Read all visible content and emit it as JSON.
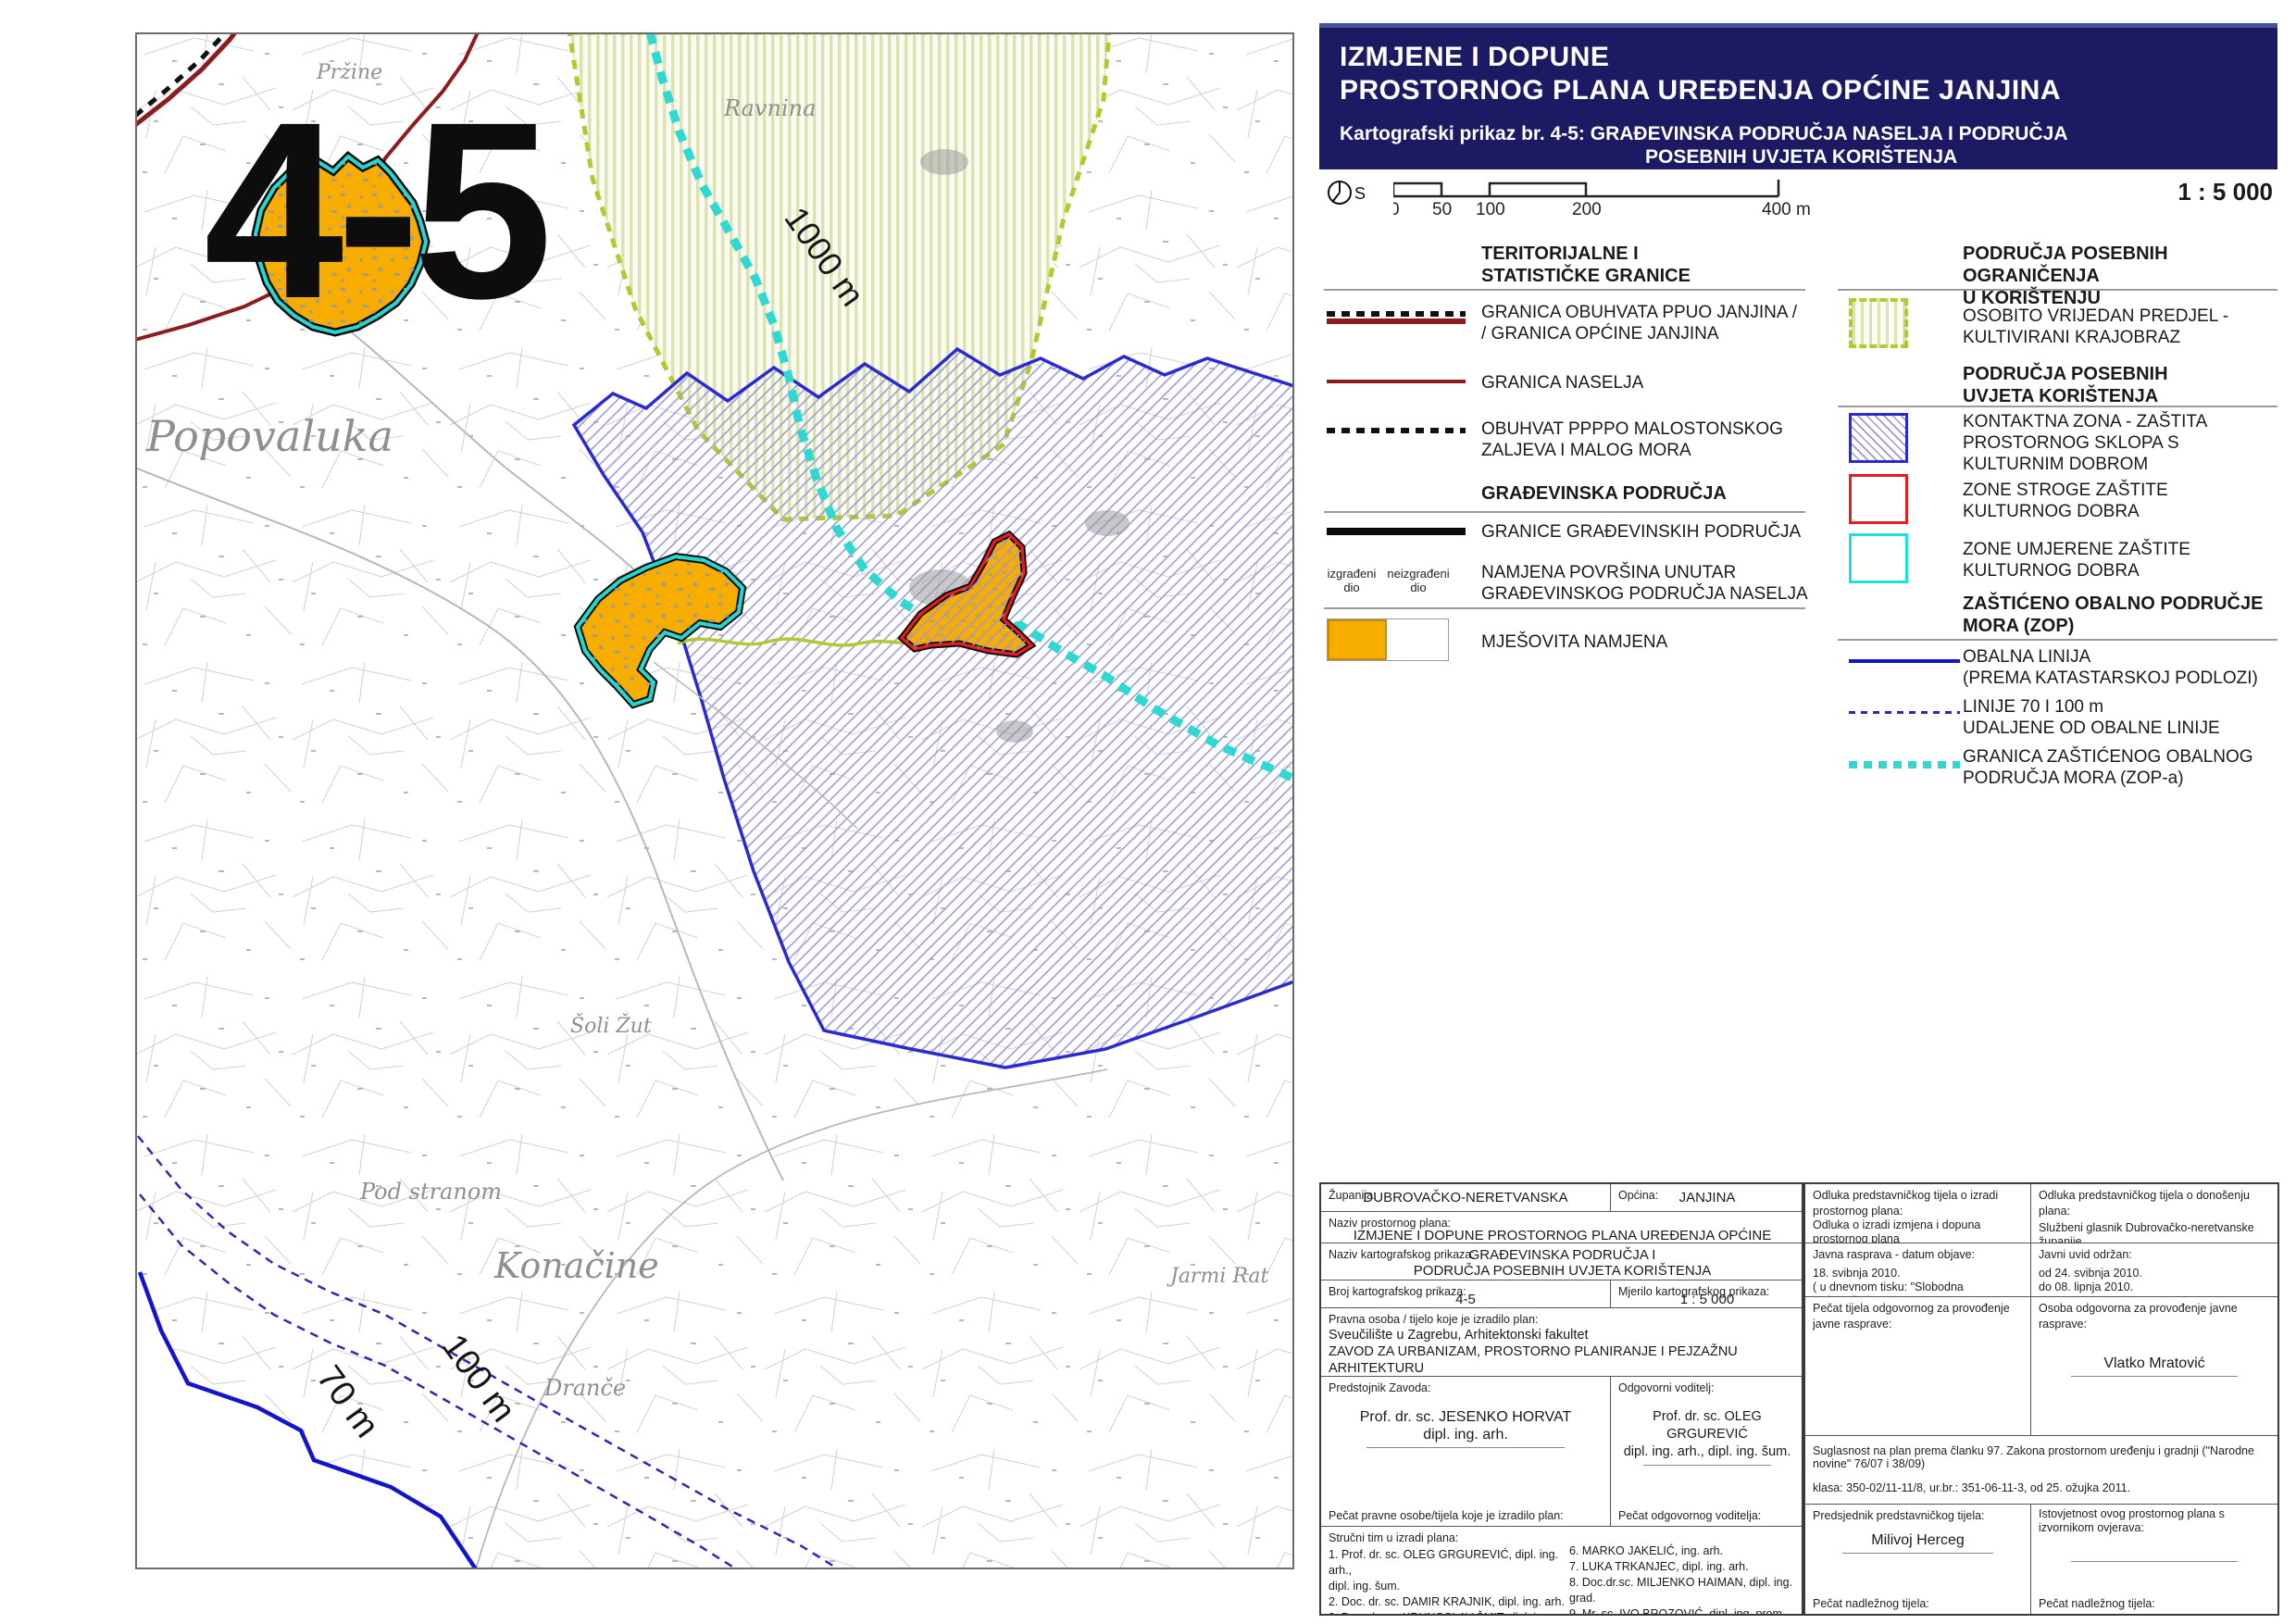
{
  "colors": {
    "title_navy": "#1b1a63",
    "mixed_use_orange": "#f7ac00",
    "settlement_border_black": "#0c0c0c",
    "settlement_inner_cyan": "#28d6d0",
    "granica_naselja_maroon": "#8e1b1e",
    "zop_cyan": "#2fd9d2",
    "coast_navy": "#1414cc",
    "kontaktna_blue": "#2a2ad0",
    "stroge_red": "#e31e1e",
    "umjerene_cyan": "#22dede",
    "krajobraz_olive": "#b5c832"
  },
  "title_block": {
    "line1": "IZMJENE I DOPUNE",
    "line2": "PROSTORNOG PLANA UREĐENJA OPĆINE JANJINA",
    "sub1": "Kartografski prikaz br. 4-5: GRAĐEVINSKA PODRUČJA NASELJA I PODRUČJA",
    "sub2": "POSEBNIH UVJETA KORIŠTENJA"
  },
  "scale_bar": {
    "north_label": "S",
    "ticks": [
      "0",
      "50",
      "100",
      "200",
      "400 m"
    ],
    "ratio": "1 : 5 000"
  },
  "legend": {
    "left": {
      "header1": "TERITORIJALNE I\nSTATISTIČKE GRANICE",
      "item1": "GRANICA OBUHVATA PPUO JANJINA /\n/ GRANICA OPĆINE JANJINA",
      "item2": "GRANICA NASELJA",
      "item3": "OBUHVAT PPPPO MALOSTONSKOG\nZALJEVA  I MALOG MORA",
      "header2": "GRAĐEVINSKA PODRUČJA",
      "item4": "GRANICE GRAĐEVINSKIH PODRUČJA",
      "built_label": "izgrađeni\ndio",
      "unbuilt_label": "neizgrađeni\ndio",
      "item5_header": "NAMJENA POVRŠINA UNUTAR\nGRAĐEVINSKOG PODRUČJA NASELJA",
      "item5": "MJEŠOVITA NAMJENA"
    },
    "right": {
      "header1": "PODRUČJA POSEBNIH OGRANIČENJA\nU KORIŠTENJU",
      "item1": "OSOBITO VRIJEDAN PREDJEL -\nKULTIVIRANI KRAJOBRAZ",
      "header2": "PODRUČJA POSEBNIH\nUVJETA KORIŠTENJA",
      "item2": "KONTAKTNA ZONA - ZAŠTITA\nPROSTORNOG SKLOPA S\nKULTURNIM DOBROM",
      "item3": "ZONE STROGE ZAŠTITE\nKULTURNOG DOBRA",
      "item4": "ZONE UMJERENE ZAŠTITE\nKULTURNOG DOBRA",
      "header3": "ZAŠTIĆENO OBALNO PODRUČJE\nMORA (ZOP)",
      "item5": "OBALNA LINIJA\n(PREMA KATASTARSKOJ PODLOZI)",
      "item6": "LINIJE 70 I 100 m\nUDALJENE OD OBALNE LINIJE",
      "item7": "GRANICA ZAŠTIĆENOG OBALNOG\nPODRUČJA MORA (ZOP-a)"
    }
  },
  "map": {
    "sheet_number": "4-5",
    "labels": [
      {
        "text": "Pržine"
      },
      {
        "text": "Ravnina"
      },
      {
        "text": "Popovaluka"
      },
      {
        "text": "Šoli Žut"
      },
      {
        "text": "Pod stranom"
      },
      {
        "text": "Konačine"
      },
      {
        "text": "Dranče"
      },
      {
        "text": "Jarmi Rat"
      },
      {
        "text": "1000 m"
      },
      {
        "text": "100 m"
      },
      {
        "text": "70 m"
      }
    ]
  },
  "table": {
    "zupanija_label": "Županija:",
    "zupanija_value": "DUBROVAČKO-NERETVANSKA",
    "opcina_label": "Općina:",
    "opcina_value": "JANJINA",
    "naziv_plana_label": "Naziv prostornog plana:",
    "naziv_plana_value": "IZMJENE I DOPUNE PROSTORNOG PLANA UREĐENJA OPĆINE JANJINA",
    "naziv_prikaza_label": "Naziv kartografskog prikaza:",
    "naziv_prikaza_value": "GRAĐEVINSKA PODRUČJA I\nPODRUČJA POSEBNIH UVJETA KORIŠTENJA",
    "broj_label": "Broj kartografskog prikaza:",
    "broj_value": "4-5",
    "mjerilo_label": "Mjerilo kartografskog prikaza:",
    "mjerilo_value": "1 : 5 000",
    "pravna_label": "Pravna osoba / tijelo koje je izradilo plan:",
    "pravna_value": "Sveučilište u Zagrebu, Arhitektonski fakultet\nZAVOD ZA URBANIZAM, PROSTORNO PLANIRANJE I PEJZAŽNU ARHITEKTURU\nZagreb, Kačićeva 26, tel./fax.(01) 4639 284; http://www.arhitekt.hr",
    "predstojnik_label": "Predstojnik Zavoda:",
    "predstojnik_name": "Prof. dr. sc. JESENKO HORVAT\ndipl. ing. arh.",
    "voditelj_label": "Odgovorni voditelj:",
    "voditelj_name": "Prof. dr. sc. OLEG GRGUREVIĆ\ndipl. ing. arh., dipl. ing. šum.",
    "pecat_pravne": "Pečat pravne osobe/tijela koje je izradilo plan:",
    "pecat_voditelja": "Pečat odgovornog voditelja:",
    "strucni_label": "Stručni tim u izradi plana:",
    "strucni_left": "1. Prof. dr. sc. OLEG GRGUREVIĆ,  dipl. ing. arh.,\n    dipl. ing. šum.\n2. Doc. dr. sc. DAMIR KRAJNIK,  dipl. ing. arh.\n3. Doc. dr. sc. KRUNOSLAV ŠMIT, dipl. ing. arh.\n4. IVONA JERKOVIĆ, dipl. ing. arh.\n5. HRVOJE VIDOVIĆ, dipl. ing. arh.",
    "strucni_right": "6. MARKO JAKELIĆ, ing. arh.\n7. LUKA TRKANJEC, dipl. ing. arh.\n8. Doc.dr.sc. MILJENKO HAIMAN, dipl. ing. grad.\n9. Mr. sc. IVO BROZOVIĆ, dipl. ing. prom.\n10. Mr. sc. HRVOJE CARIĆ, dipl. stručnjak zaštite\n      okoliša, dipl. oecc.\n11. DEANKA HIRJAN, dipl. iur.",
    "odluka_izrada_label": "Odluka predstavničkog tijela o izradi prostornog plana:",
    "odluka_izrada_value": "Odluka o izradi izmjena i dopuna prostornog plana\nOpćine Janjina (Sl. glasnik Dubrovačko-neretvanske\nžupanije broj 12/2009, 03. prosinca 2009. godine.)",
    "odluka_donosenje_label": "Odluka predstavničkog tijela o donošenju plana:",
    "odluka_donosenje_value": "Službeni glasnik Dubrovačko-neretvanske županije\nbroj 03/2011 od 02. svibnja 2011.",
    "javna_label": "Javna rasprava - datum objave:",
    "javna_value": "18. svibnja 2010.\n( u dnevnom tisku: \"Slobodna Dalmacija\")",
    "uvid_label": "Javni uvid održan:",
    "uvid_value": "od 24. svibnja 2010.\ndo 08. lipnja 2010.",
    "pecat_tijela": "Pečat tijela odgovornog za provođenje javne rasprave:",
    "osoba_label": "Osoba odgovorna za provođenje javne rasprave:",
    "osoba_name": "Vlatko Mratović",
    "suglasnost": "Suglasnost na plan prema članku 97. Zakona prostornom uređenju i gradnji (\"Narodne novine\" 76/07 i 38/09)",
    "klasa": "klasa: 350-02/11-11/8, ur.br.: 351-06-11-3, od 25. ožujka 2011.",
    "predsjednik_label": "Predsjednik predstavničkog tijela:",
    "predsjednik_name": "Milivoj Herceg",
    "istovjetnost_label": "Istovjetnost ovog prostornog plana s\nizvornikom ovjerava:",
    "pecat_nadleznog1": "Pečat nadležnog tijela:",
    "pecat_nadleznog2": "Pečat nadležnog tijela:"
  }
}
